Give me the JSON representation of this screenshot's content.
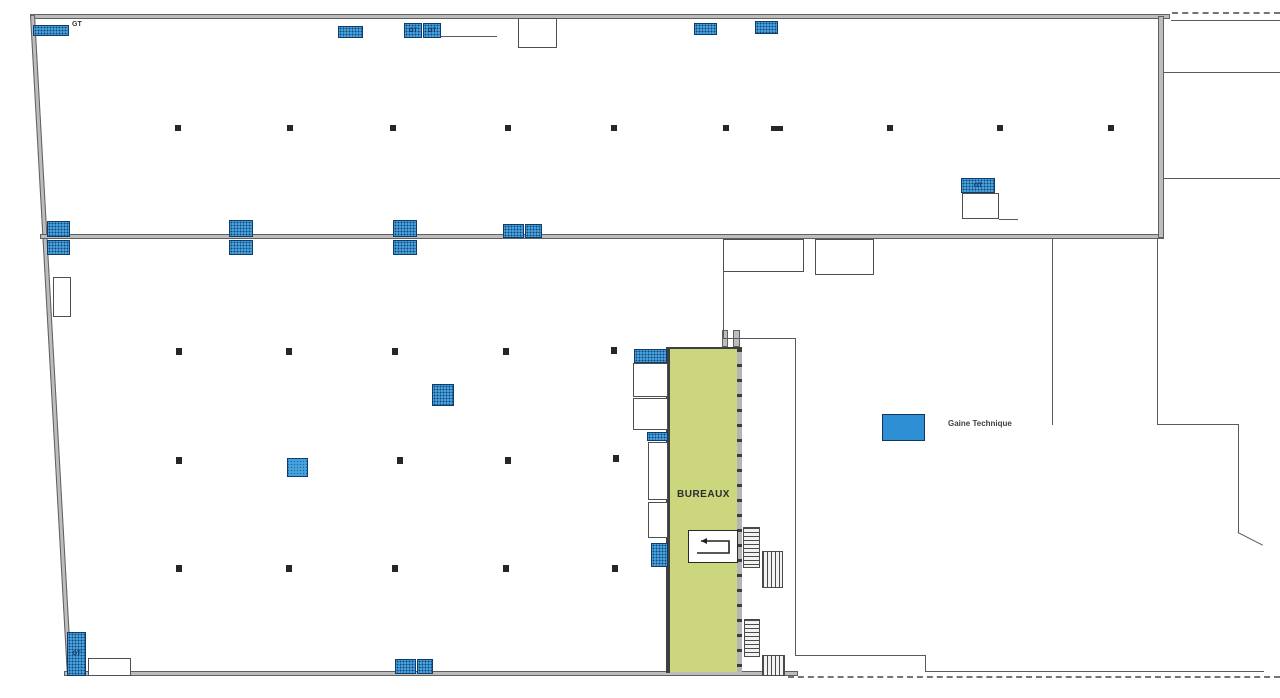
{
  "labels": {
    "gt": "GT",
    "bureaux": "BUREAUX",
    "legend_gaine": "Gaine Technique"
  },
  "colors": {
    "wall": "#bdbdbd",
    "wall_edge": "#5f5f5f",
    "gt_fill": "#45a1de",
    "gt_border": "#0e3d6b",
    "bureaux_fill": "#ccd67c",
    "legend_fill": "#2e8fd4",
    "column": "#262626"
  },
  "bureaux": {
    "rect": {
      "x": 670,
      "y": 349,
      "w": 67,
      "h": 323
    }
  },
  "bureaux_right_wall": {
    "rect": {
      "x": 737,
      "y": 349,
      "w": 5,
      "h": 323
    }
  },
  "ramp": {
    "rect": {
      "x": 688,
      "y": 530,
      "w": 50,
      "h": 33
    }
  },
  "legend": {
    "rect": {
      "x": 882,
      "y": 414,
      "w": 43,
      "h": 27
    }
  },
  "geometry": {
    "walls": [
      {
        "x": 30,
        "y": 14,
        "w": 1140,
        "h": 5
      },
      {
        "x": 30,
        "y": 15,
        "w": 5,
        "h": 662,
        "rot": -3.2
      },
      {
        "x": 40,
        "y": 234,
        "w": 1124,
        "h": 5
      },
      {
        "x": 1158,
        "y": 16,
        "w": 6,
        "h": 222
      },
      {
        "x": 64,
        "y": 671,
        "w": 734,
        "h": 5
      },
      {
        "x": 722,
        "y": 330,
        "w": 6,
        "h": 17
      },
      {
        "x": 733,
        "y": 330,
        "w": 7,
        "h": 17
      },
      {
        "x": 666,
        "y": 347,
        "w": 76,
        "h": 3,
        "variant": "dark"
      },
      {
        "x": 666,
        "y": 349,
        "w": 4,
        "h": 324,
        "variant": "dark"
      }
    ],
    "lines": [
      {
        "x": 1171,
        "y": 20,
        "w": 109,
        "h": 1
      },
      {
        "x": 1164,
        "y": 72,
        "w": 116,
        "h": 1
      },
      {
        "x": 1164,
        "y": 178,
        "w": 116,
        "h": 1
      },
      {
        "x": 1052,
        "y": 239,
        "w": 1,
        "h": 186
      },
      {
        "x": 1157,
        "y": 239,
        "w": 1,
        "h": 186
      },
      {
        "x": 1157,
        "y": 424,
        "w": 82,
        "h": 1
      },
      {
        "x": 1238,
        "y": 424,
        "w": 1,
        "h": 109
      },
      {
        "x": 1238,
        "y": 532,
        "w": 28,
        "h": 1,
        "rot": 27
      },
      {
        "x": 795,
        "y": 338,
        "w": 1,
        "h": 318
      },
      {
        "x": 795,
        "y": 655,
        "w": 131,
        "h": 1
      },
      {
        "x": 925,
        "y": 655,
        "w": 1,
        "h": 17
      },
      {
        "x": 925,
        "y": 671,
        "w": 339,
        "h": 1
      },
      {
        "x": 723,
        "y": 272,
        "w": 1,
        "h": 67
      },
      {
        "x": 723,
        "y": 338,
        "w": 73,
        "h": 1
      },
      {
        "x": 440,
        "y": 36,
        "w": 57,
        "h": 1
      },
      {
        "x": 999,
        "y": 219,
        "w": 19,
        "h": 1
      },
      {
        "x": 752,
        "y": 239,
        "w": 1,
        "h": 33
      },
      {
        "x": 842,
        "y": 239,
        "w": 1,
        "h": 36
      }
    ],
    "rooms": [
      {
        "x": 518,
        "y": 18,
        "w": 39,
        "h": 30
      },
      {
        "x": 53,
        "y": 277,
        "w": 18,
        "h": 40
      },
      {
        "x": 88,
        "y": 658,
        "w": 43,
        "h": 18
      },
      {
        "x": 962,
        "y": 193,
        "w": 37,
        "h": 26
      },
      {
        "x": 723,
        "y": 239,
        "w": 81,
        "h": 33
      },
      {
        "x": 815,
        "y": 239,
        "w": 59,
        "h": 36
      },
      {
        "x": 633,
        "y": 363,
        "w": 35,
        "h": 34
      },
      {
        "x": 633,
        "y": 398,
        "w": 35,
        "h": 32
      },
      {
        "x": 648,
        "y": 442,
        "w": 20,
        "h": 58
      },
      {
        "x": 648,
        "y": 502,
        "w": 20,
        "h": 36
      }
    ],
    "gt_boxes": [
      {
        "x": 33,
        "y": 25,
        "w": 36,
        "h": 11
      },
      {
        "x": 338,
        "y": 26,
        "w": 25,
        "h": 12
      },
      {
        "x": 404,
        "y": 23,
        "w": 18,
        "h": 15,
        "label": "GT"
      },
      {
        "x": 423,
        "y": 23,
        "w": 18,
        "h": 15,
        "label": "GT"
      },
      {
        "x": 694,
        "y": 23,
        "w": 23,
        "h": 12
      },
      {
        "x": 755,
        "y": 21,
        "w": 23,
        "h": 13
      },
      {
        "x": 47,
        "y": 221,
        "w": 23,
        "h": 16
      },
      {
        "x": 47,
        "y": 240,
        "w": 23,
        "h": 15
      },
      {
        "x": 229,
        "y": 220,
        "w": 24,
        "h": 17
      },
      {
        "x": 229,
        "y": 240,
        "w": 24,
        "h": 15
      },
      {
        "x": 393,
        "y": 220,
        "w": 24,
        "h": 17
      },
      {
        "x": 393,
        "y": 240,
        "w": 24,
        "h": 15
      },
      {
        "x": 503,
        "y": 224,
        "w": 21,
        "h": 14
      },
      {
        "x": 525,
        "y": 224,
        "w": 17,
        "h": 14
      },
      {
        "x": 961,
        "y": 178,
        "w": 34,
        "h": 15,
        "label": "GT"
      },
      {
        "x": 634,
        "y": 349,
        "w": 33,
        "h": 14
      },
      {
        "x": 647,
        "y": 432,
        "w": 21,
        "h": 9
      },
      {
        "x": 651,
        "y": 543,
        "w": 17,
        "h": 24
      },
      {
        "x": 432,
        "y": 384,
        "w": 22,
        "h": 22
      },
      {
        "x": 287,
        "y": 458,
        "w": 21,
        "h": 19,
        "variant": "diag"
      },
      {
        "x": 67,
        "y": 632,
        "w": 19,
        "h": 44,
        "label": "GT"
      },
      {
        "x": 395,
        "y": 659,
        "w": 21,
        "h": 15
      },
      {
        "x": 417,
        "y": 659,
        "w": 16,
        "h": 15
      }
    ],
    "columns": [
      {
        "x": 175,
        "y": 125,
        "w": 6,
        "h": 6
      },
      {
        "x": 287,
        "y": 125,
        "w": 6,
        "h": 6
      },
      {
        "x": 390,
        "y": 125,
        "w": 6,
        "h": 6
      },
      {
        "x": 505,
        "y": 125,
        "w": 6,
        "h": 6
      },
      {
        "x": 611,
        "y": 125,
        "w": 6,
        "h": 6
      },
      {
        "x": 723,
        "y": 125,
        "w": 6,
        "h": 6
      },
      {
        "x": 771,
        "y": 126,
        "w": 12,
        "h": 5
      },
      {
        "x": 887,
        "y": 125,
        "w": 6,
        "h": 6
      },
      {
        "x": 997,
        "y": 125,
        "w": 6,
        "h": 6
      },
      {
        "x": 1108,
        "y": 125,
        "w": 6,
        "h": 6
      },
      {
        "x": 176,
        "y": 348,
        "w": 6,
        "h": 7
      },
      {
        "x": 286,
        "y": 348,
        "w": 6,
        "h": 7
      },
      {
        "x": 392,
        "y": 348,
        "w": 6,
        "h": 7
      },
      {
        "x": 503,
        "y": 348,
        "w": 6,
        "h": 7
      },
      {
        "x": 611,
        "y": 347,
        "w": 6,
        "h": 7
      },
      {
        "x": 176,
        "y": 457,
        "w": 6,
        "h": 7
      },
      {
        "x": 397,
        "y": 457,
        "w": 6,
        "h": 7
      },
      {
        "x": 505,
        "y": 457,
        "w": 6,
        "h": 7
      },
      {
        "x": 613,
        "y": 455,
        "w": 6,
        "h": 7
      },
      {
        "x": 176,
        "y": 565,
        "w": 6,
        "h": 7
      },
      {
        "x": 286,
        "y": 565,
        "w": 6,
        "h": 7
      },
      {
        "x": 392,
        "y": 565,
        "w": 6,
        "h": 7
      },
      {
        "x": 503,
        "y": 565,
        "w": 6,
        "h": 7
      },
      {
        "x": 612,
        "y": 565,
        "w": 6,
        "h": 7
      }
    ],
    "stairs": [
      {
        "x": 743,
        "y": 527,
        "w": 17,
        "h": 41,
        "variant": "h"
      },
      {
        "x": 762,
        "y": 551,
        "w": 21,
        "h": 37,
        "variant": "v"
      },
      {
        "x": 744,
        "y": 619,
        "w": 16,
        "h": 38,
        "variant": "h"
      },
      {
        "x": 762,
        "y": 655,
        "w": 23,
        "h": 21,
        "variant": "v"
      }
    ],
    "dashes": [
      {
        "x": 1172,
        "y": 12,
        "w": 108,
        "h": 0
      },
      {
        "x": 788,
        "y": 676,
        "w": 492,
        "h": 0
      }
    ]
  }
}
